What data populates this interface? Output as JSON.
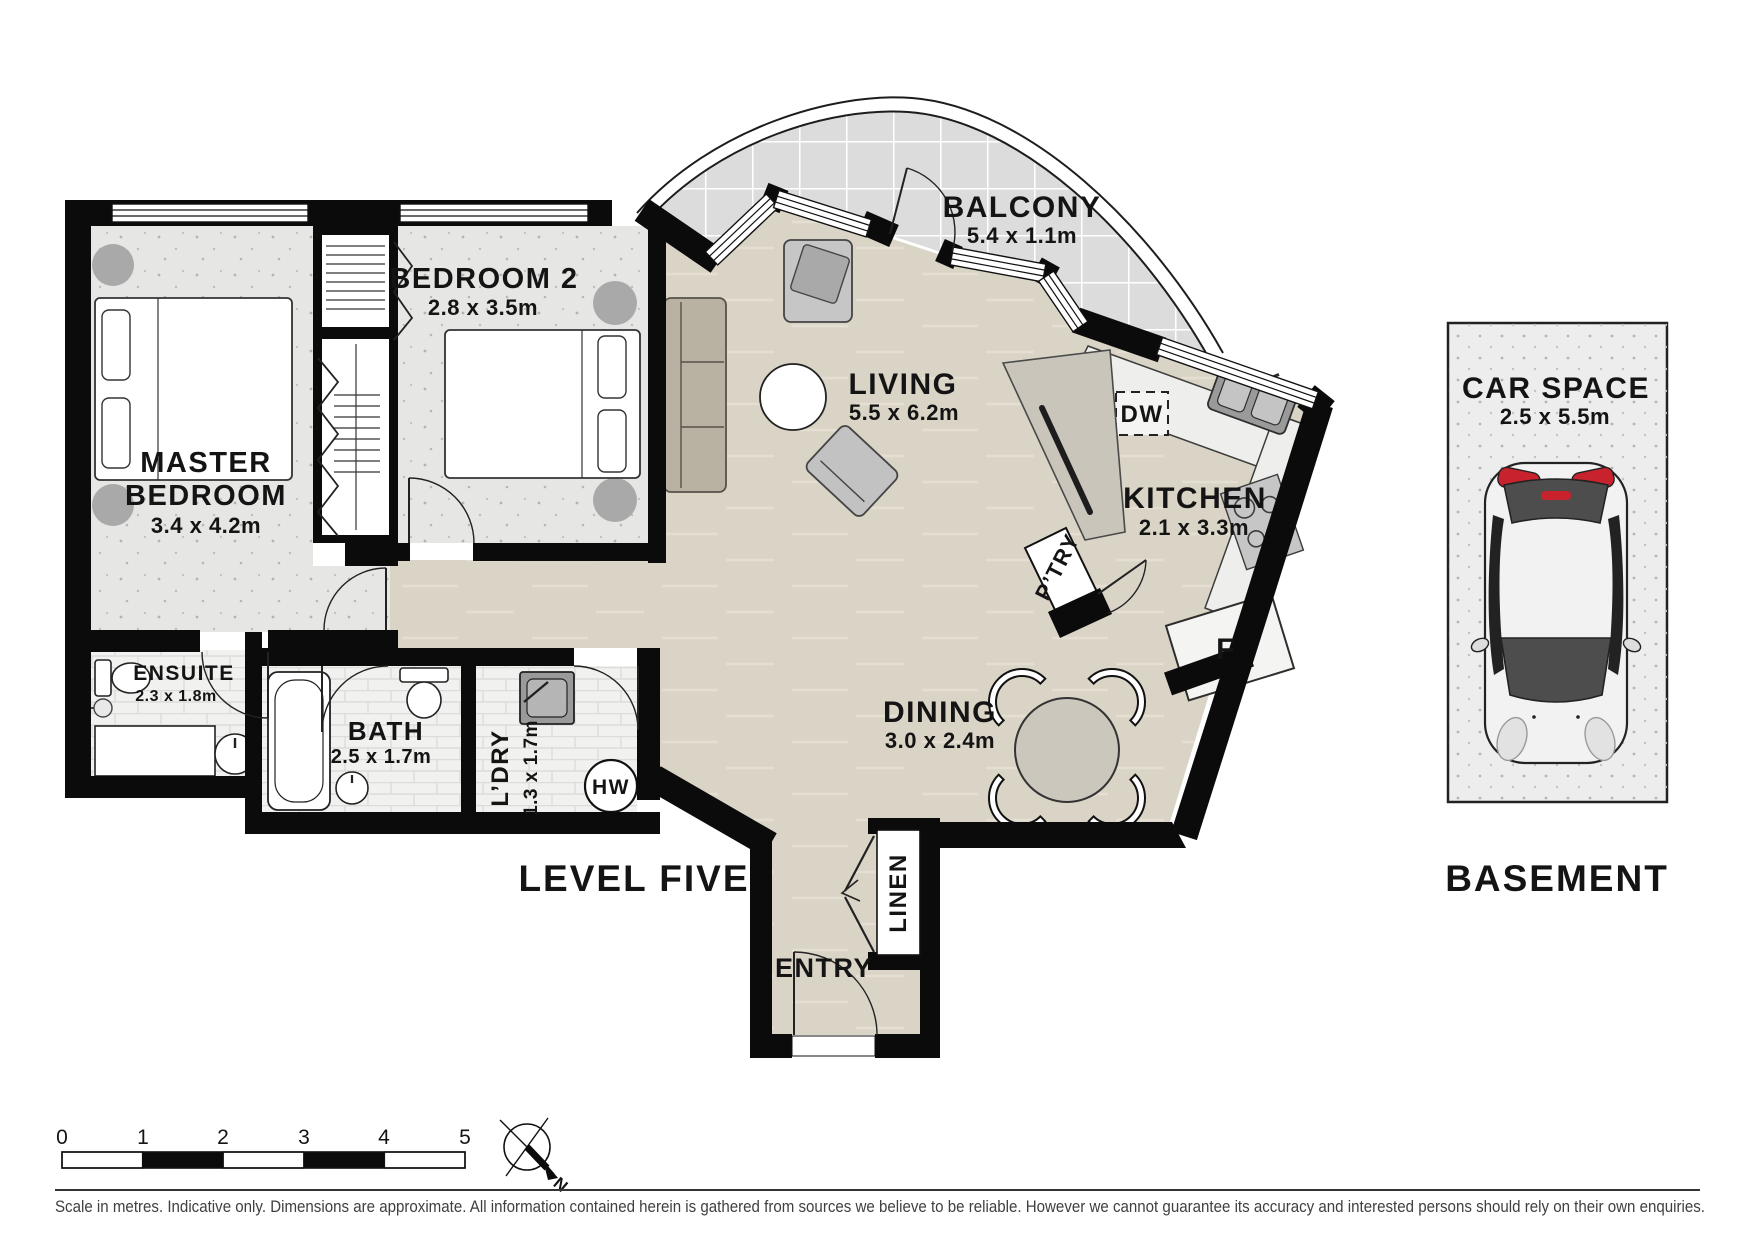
{
  "plan": {
    "title": "LEVEL FIVE",
    "rooms": {
      "balcony": {
        "name": "BALCONY",
        "dims": "5.4 x 1.1m"
      },
      "living": {
        "name": "LIVING",
        "dims": "5.5 x 6.2m"
      },
      "kitchen": {
        "name": "KITCHEN",
        "dims": "2.1 x 3.3m"
      },
      "dining": {
        "name": "DINING",
        "dims": "3.0 x 2.4m"
      },
      "bedroom2": {
        "name": "BEDROOM 2",
        "dims": "2.8 x 3.5m"
      },
      "master": {
        "name_line1": "MASTER",
        "name_line2": "BEDROOM",
        "dims": "3.4 x 4.2m"
      },
      "ensuite": {
        "name": "ENSUITE",
        "dims": "2.3 x 1.8m"
      },
      "bath": {
        "name": "BATH",
        "dims": "2.5 x 1.7m"
      },
      "laundry": {
        "name": "L’DRY",
        "dims": "1.3 x 1.7m"
      },
      "entry": {
        "name": "ENTRY"
      },
      "linen": {
        "name": "LINEN"
      },
      "pantry": {
        "name": "P’TRY"
      }
    },
    "fixtures": {
      "dishwasher": "DW",
      "fridge": "F",
      "hot_water": "HW"
    }
  },
  "basement": {
    "title": "BASEMENT",
    "car_space": {
      "name": "CAR SPACE",
      "dims": "2.5 x 5.5m"
    }
  },
  "scale_bar": {
    "ticks": [
      "0",
      "1",
      "2",
      "3",
      "4",
      "5"
    ]
  },
  "compass": {
    "north_label": "N"
  },
  "footer": {
    "disclaimer": "Scale in metres. Indicative only. Dimensions are approximate. All information contained herein is gathered from sources we believe to be reliable. However we cannot guarantee its accuracy and interested persons should rely on their own enquiries."
  },
  "colors": {
    "wall": "#0b0b0b",
    "floor_timber": "#d9d4c6",
    "floor_carpet": "#e6e6e4",
    "floor_tile": "#f1f1f0",
    "balcony": "#dcdcdc",
    "bench_gray": "#c9c5bb",
    "accent_red": "#c8232c"
  }
}
